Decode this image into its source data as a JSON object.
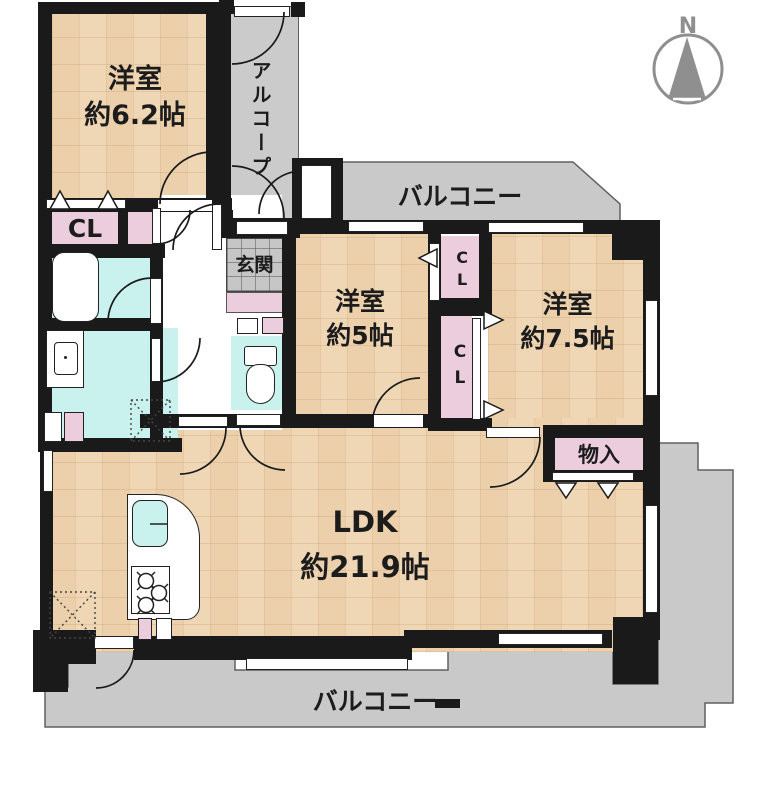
{
  "plan_title": "floor-plan",
  "colors": {
    "wall": "#1a1a1a",
    "tatami": "#efd6b4",
    "balcony_gray": "#c9c9c9",
    "closet_pink": "#eccdde",
    "wet_cyan": "#c9f2ee",
    "compass_gray": "#8f8f8f"
  },
  "compass": {
    "north_label": "N"
  },
  "rooms": {
    "bedroom_62": {
      "name": "洋室",
      "size": "約6.2帖"
    },
    "bedroom_5": {
      "name": "洋室",
      "size": "約5帖"
    },
    "bedroom_75": {
      "name": "洋室",
      "size": "約7.5帖"
    },
    "ldk": {
      "name": "LDK",
      "size": "約21.9帖"
    }
  },
  "areas": {
    "alcove": {
      "label": "アルコープ"
    },
    "entrance": {
      "label": "玄関"
    },
    "balcony_top": {
      "label": "バルコニー"
    },
    "balcony_bottom": {
      "label": "バルコニー"
    },
    "closet_main": {
      "label": "CL"
    },
    "closet_upper": {
      "label": "CL"
    },
    "closet_lower": {
      "label": "CL"
    },
    "storage": {
      "label": "物入"
    }
  }
}
